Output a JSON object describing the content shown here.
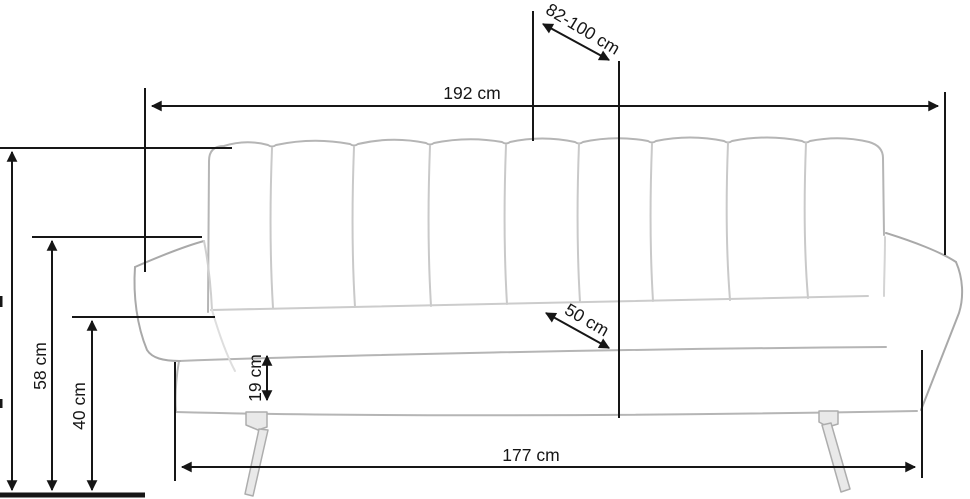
{
  "diagram": {
    "title": "Sofa dimension drawing",
    "subject": "three-seat sofa with channel-tufted backrest, metal legs",
    "units": "cm",
    "colors": {
      "background": "#ffffff",
      "dimension_lines": "#161616",
      "sofa_outline": "#b5b5b5",
      "sofa_seam": "#c9c9c9",
      "leg_fill": "#e9e9e9"
    },
    "dimensions": {
      "backrest_recline_depth": "82-100 cm",
      "overall_width": "192 cm",
      "armrest_height": "58 cm",
      "seat_height": "40 cm",
      "seat_panel_height": "19 cm",
      "seat_depth": "50 cm",
      "base_width": "177 cm"
    }
  }
}
